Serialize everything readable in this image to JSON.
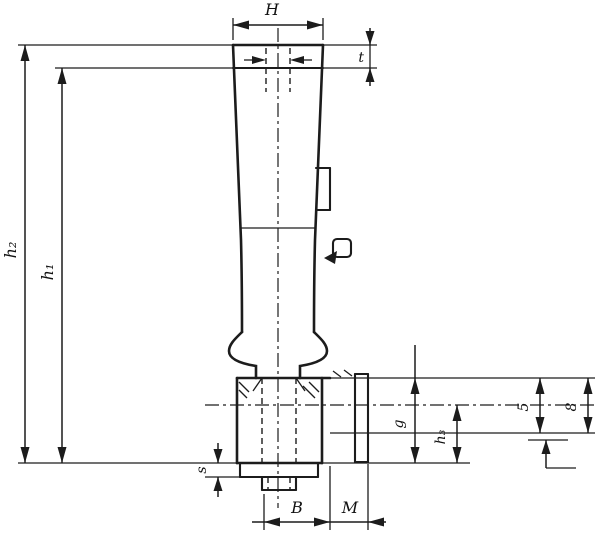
{
  "drawing": {
    "kind": "technical dimension drawing of a revolving machine handle mounted on a base, sectioned mount with threaded stud",
    "background_color": "#ffffff",
    "line_color": "#1c1c1c",
    "labels": {
      "top_width": "H",
      "crown_height": "t",
      "overall_height": "h₂",
      "grip_height": "h₁",
      "hub_height": "g",
      "lower_height": "h₃",
      "bore_depth": "5",
      "rim_thickness": "8",
      "collar_height": "s",
      "base_width": "B",
      "thread": "M"
    }
  }
}
